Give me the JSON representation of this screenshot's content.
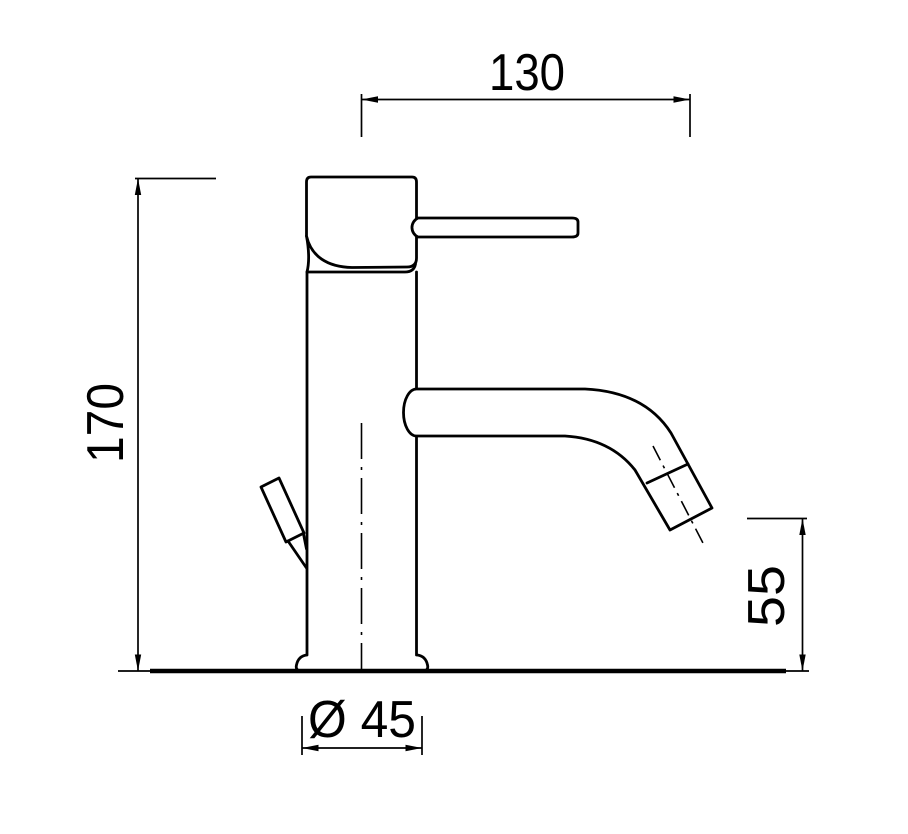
{
  "drawing": {
    "subject": "single-lever-basin-mixer-side-view",
    "background_color": "#ffffff",
    "ink_color": "#000000",
    "dimensions": [
      {
        "name": "spout-reach",
        "value": "130",
        "orientation": "horizontal"
      },
      {
        "name": "overall-height",
        "value": "170",
        "orientation": "vertical"
      },
      {
        "name": "outlet-height",
        "value": "55",
        "orientation": "vertical"
      },
      {
        "name": "base-diameter",
        "value": "Ø 45",
        "orientation": "horizontal",
        "symbol": "diameter-sign"
      }
    ]
  }
}
